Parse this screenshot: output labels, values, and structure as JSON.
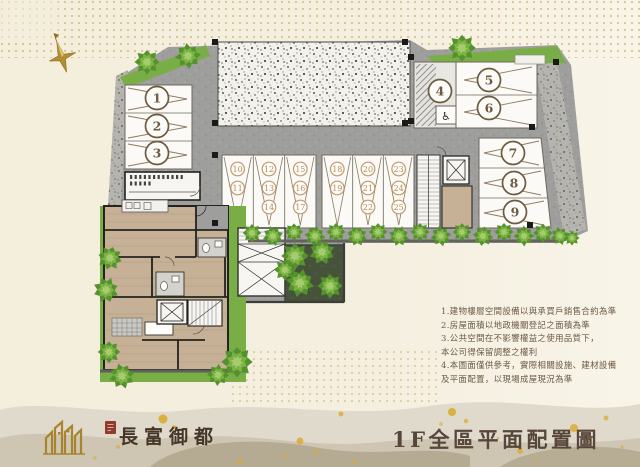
{
  "parking": {
    "car_spaces": [
      "1",
      "2",
      "3",
      "4",
      "5",
      "6",
      "7",
      "8",
      "9"
    ],
    "motorcycle_spaces": [
      "10",
      "11",
      "12",
      "13",
      "14",
      "15",
      "16",
      "17",
      "18",
      "19",
      "20",
      "21",
      "22",
      "23",
      "24",
      "25"
    ],
    "accessible_symbol": "♿"
  },
  "notes": {
    "lines": [
      "1.建物樓層空間設備以與承買戶銷售合約為準",
      "2.房屋面積以地政機關登記之面積為準",
      "3.公共空間在不影響權益之使用品質下，",
      "本公司得保留調整之權利",
      "4.本圖面僅供參考，實際相關設施、建材設備",
      "及平面配置，以現場成屋現況為準"
    ]
  },
  "footer": {
    "brand_name": "長富御都",
    "plan_title": "1F全區平面配置圖"
  },
  "colors": {
    "accent_gold": "#c49f44",
    "title_brown": "#57463a",
    "notes_brown": "#6b5845",
    "road_gray": "#9e9e9c",
    "grass_green": "#76b043",
    "wood_tan": "#c6b096",
    "seal_red": "#93392e"
  }
}
